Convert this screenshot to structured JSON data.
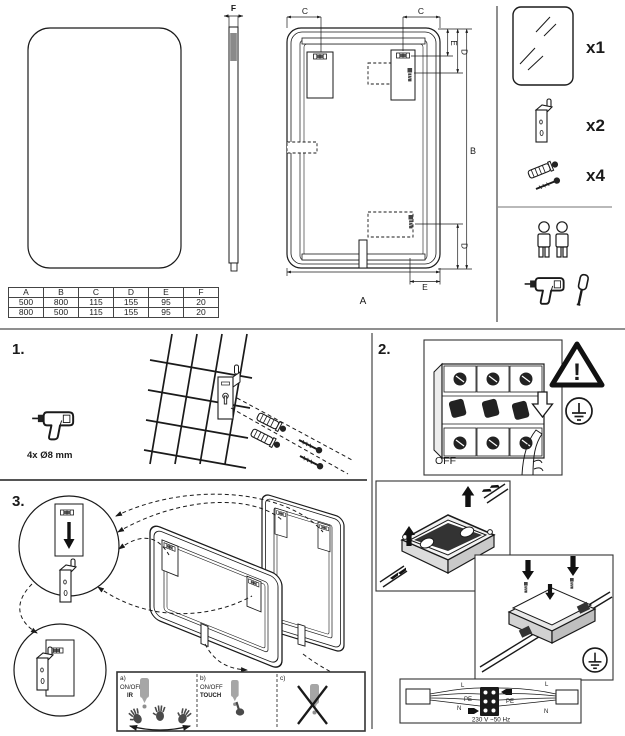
{
  "colors": {
    "ink": "#1a1a1a",
    "divider": "#8f8f8f",
    "sensor_gray": "#a6a6a6",
    "hand_gray": "#4a4a4a"
  },
  "top_section": {
    "side_view": {
      "dim_f": "F"
    },
    "back_view": {
      "dim_c_left": "C",
      "dim_c_right": "C",
      "dim_e_top": "E",
      "dim_d_top": "D",
      "dim_b": "B",
      "dim_d_bottom": "D",
      "dim_e_bottom": "E",
      "dim_a": "A"
    },
    "dimension_table": {
      "headers": [
        "A",
        "B",
        "C",
        "D",
        "E",
        "F"
      ],
      "rows": [
        [
          "500",
          "800",
          "115",
          "155",
          "95",
          "20"
        ],
        [
          "800",
          "500",
          "115",
          "155",
          "95",
          "20"
        ]
      ]
    },
    "parts_list": {
      "mirror_qty": "x1",
      "bracket_qty": "x2",
      "fixings_qty": "x4"
    }
  },
  "step1": {
    "number": "1.",
    "drill_spec": "4x Ø8 mm"
  },
  "step2": {
    "number": "2.",
    "breaker_label": "OFF",
    "warning_mark": "!",
    "wiring": {
      "l_left": "L",
      "pe_left": "PE",
      "n_left": "N",
      "l_right": "L",
      "pe_right": "PE",
      "n_right": "N",
      "voltage": "230 V ~50 Hz"
    }
  },
  "step3": {
    "number": "3.",
    "controls": {
      "a_key": "a)",
      "a_mode": "ON/OFF",
      "a_type": "IR",
      "b_key": "b)",
      "b_mode": "ON/OFF",
      "b_type": "TOUCH",
      "c_key": "c)"
    }
  }
}
